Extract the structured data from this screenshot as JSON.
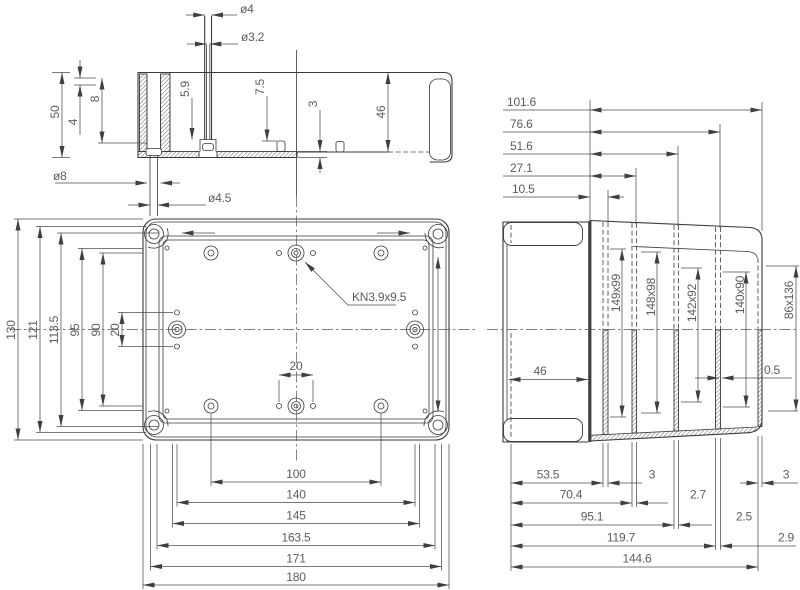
{
  "drawing": {
    "title": "enclosure-technical-drawing",
    "section_view": {
      "dia4": "ø4",
      "dia3_2": "ø3.2",
      "h5_9": "5.9",
      "h7_5": "7.5",
      "thk3": "3",
      "d46": "46",
      "h50": "50",
      "h8": "8",
      "h4": "4",
      "dia8": "ø8",
      "dia4_5": "ø4.5"
    },
    "plan_view": {
      "height_dims": [
        "130",
        "121",
        "113.5",
        "95",
        "90"
      ],
      "pitch20_v": "20",
      "pitch20_h": "20",
      "width_dims": [
        "100",
        "140",
        "145",
        "163.5",
        "171",
        "180"
      ],
      "callout": "KN3.9x9.5"
    },
    "side_view": {
      "top_dims": [
        "101.6",
        "76.6",
        "51.6",
        "27.1",
        "10.5"
      ],
      "inner_depth": "46",
      "openings": [
        "149x99",
        "148x98",
        "142x92",
        "140x90",
        "86x136"
      ],
      "offset": "0.5",
      "bottom_dims": [
        "53.5",
        "70.4",
        "95.1",
        "119.7",
        "144.6"
      ],
      "wall_thks": [
        "3",
        "2.7",
        "2.5",
        "2.9"
      ],
      "outer_thk": "3"
    },
    "colors": {
      "line": "#3a3a3a",
      "dim_text": "#5c5c5c",
      "background": "#ffffff"
    }
  }
}
